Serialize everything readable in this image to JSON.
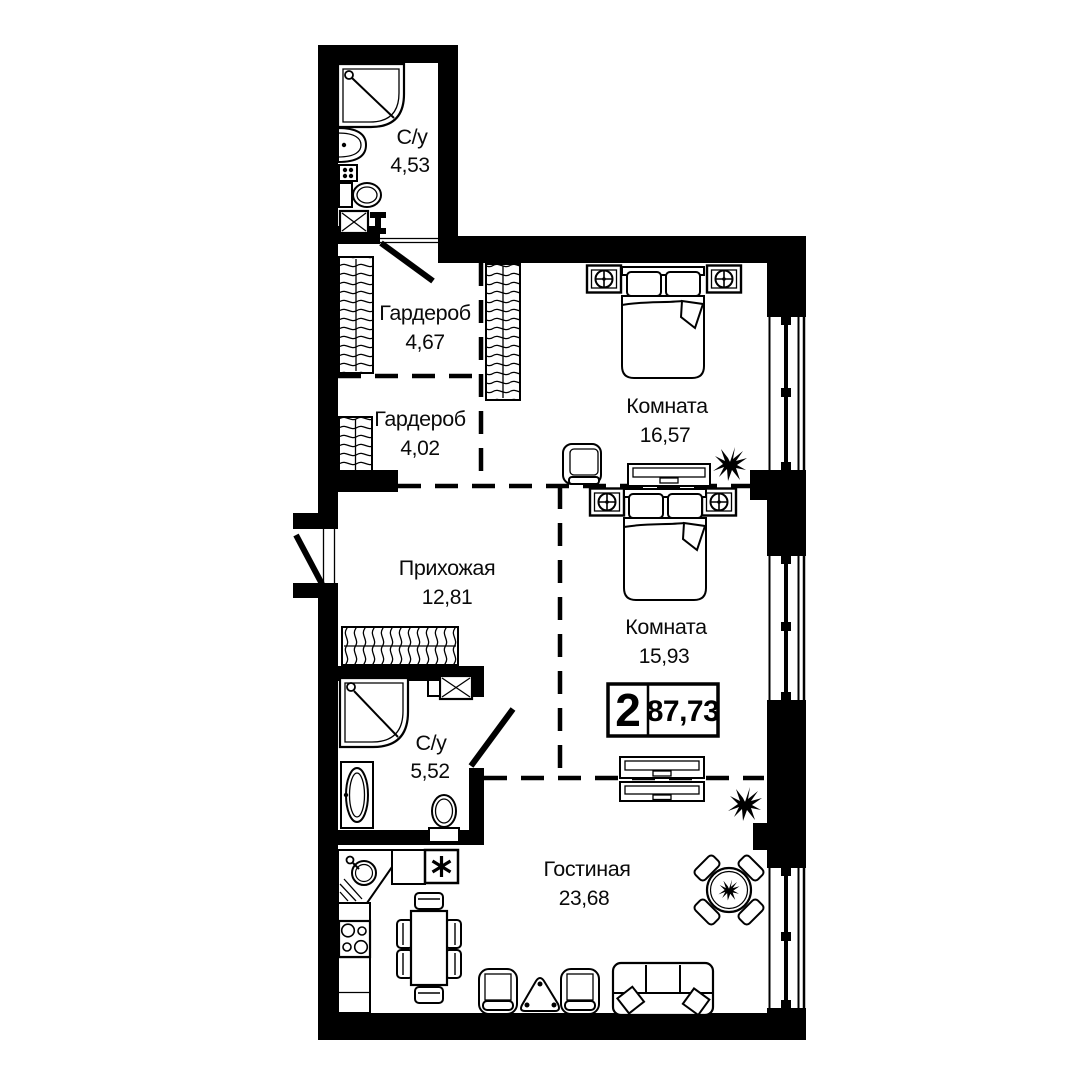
{
  "plan": {
    "badge": {
      "rooms_count": "2",
      "total_area": "87,73"
    },
    "rooms": [
      {
        "id": "bath1",
        "name": "С/у",
        "area": "4,53"
      },
      {
        "id": "ward1",
        "name": "Гардероб",
        "area": "4,67"
      },
      {
        "id": "ward2",
        "name": "Гардероб",
        "area": "4,02"
      },
      {
        "id": "hall",
        "name": "Прихожая",
        "area": "12,81"
      },
      {
        "id": "bed1",
        "name": "Комната",
        "area": "16,57"
      },
      {
        "id": "bed2",
        "name": "Комната",
        "area": "15,93"
      },
      {
        "id": "bath2",
        "name": "С/у",
        "area": "5,52"
      },
      {
        "id": "living",
        "name": "Гостиная",
        "area": "23,68"
      }
    ],
    "furniture_icons": [
      "shower-icon",
      "sink-icon",
      "toilet-icon",
      "washing-machine-icon",
      "wardrobe-rail-icon",
      "closet-icon",
      "bed-icon",
      "nightstand-lamp-icon",
      "dresser-icon",
      "armchair-icon",
      "plant-icon",
      "kitchen-corner-sink-icon",
      "stove-icon",
      "dining-table-icon",
      "coffee-table-icon",
      "sofa-icon",
      "round-table-icon",
      "window-icon",
      "door-swing-icon"
    ],
    "colors": {
      "wall": "#000000",
      "background": "#ffffff",
      "line": "#0a0a0a"
    }
  }
}
